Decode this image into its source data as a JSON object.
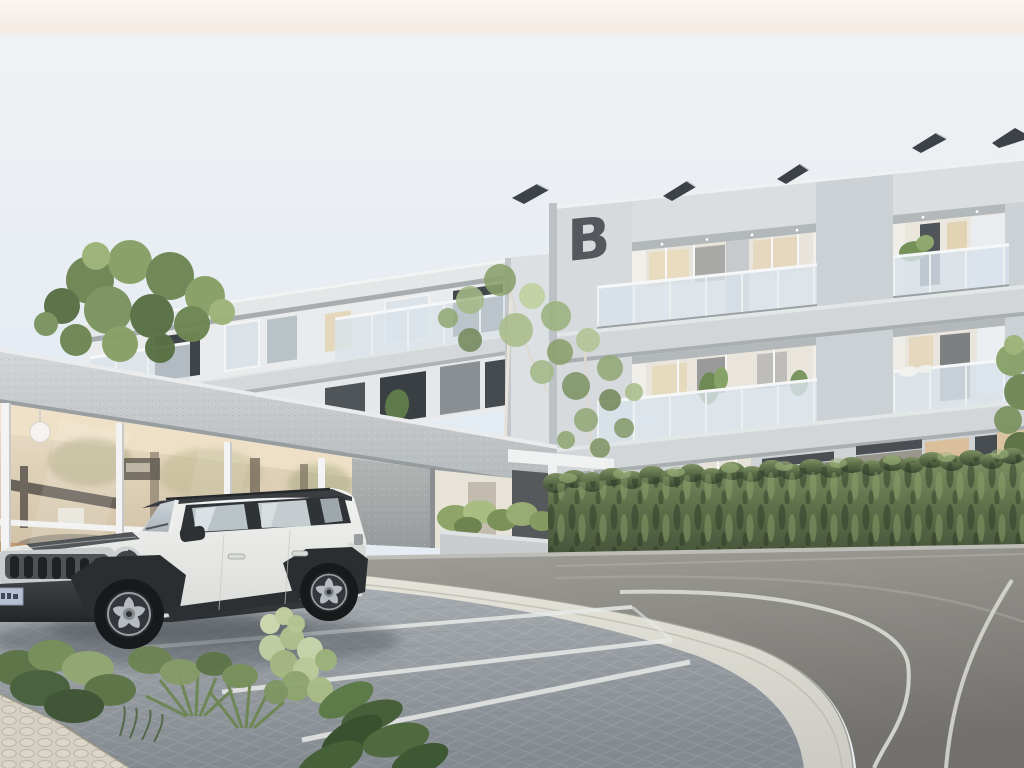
{
  "scene": {
    "kind": "3D architectural exterior rendering",
    "description": "Modern three-storey apartment complex with light concrete facade, recessed glass balconies, rooftop solar panels and a letter logo on the parapet; glazed amenity space under a concrete carport pergola; white compact SUV parked on a paver lot; tall green hedge along a curved asphalt road with white lane markings; landscaped shrubs and cobble walkway in the foreground",
    "time_of_day": "daylight"
  },
  "frame": {
    "width": 1024,
    "height": 768,
    "top_banner_color": "#f6ece5"
  },
  "sky": {
    "top": "#f1f2f3",
    "mid": "#e3ebf3",
    "bottom": "#e9eef2"
  },
  "building": {
    "logo_letter": "B",
    "logo_color": "#54585c",
    "facade_color": "#ccd1d5",
    "parapet_color": "#dadee0",
    "recess_color": "#f1efea",
    "balcony_glass_color": "#d8e2ea",
    "floors_visible": 3,
    "balcony_bays": 2,
    "solar_panels": 5,
    "solar_panel_color": "#3d4248"
  },
  "left_wing": {
    "facade_color": "#e9ebec",
    "roof_color": "#e4e7e8",
    "floors_visible": 2
  },
  "pergola": {
    "beam_color": "#d3d6d8",
    "column_color": "#f2f3f2"
  },
  "amenity": {
    "glass_top": "#ecdfc8",
    "glass_bottom": "#c8b89c",
    "lamp": "white globe pendant",
    "counter_color": "#b98a5c"
  },
  "entry": {
    "portal_color": "#f0f1f1",
    "gate_color": "#55595c",
    "stone_wall_color": "#aaadae",
    "planter_color": "#c9cdcf"
  },
  "vehicle": {
    "type": "compact SUV",
    "body_color": "#f2f3f1",
    "roof_color": "#3a3e41",
    "glass_color": "#b9c3c8",
    "grille_slots": 7,
    "plate_color": "#b7c0d2",
    "wheel_spoke_color": "#b6bbbf"
  },
  "landscape": {
    "hedge_top_color": "#7f9263",
    "hedge_mid_color": "#5a6b47",
    "hedge_bottom_color": "#3f4b35",
    "hedge_highlight": "#a3b77f",
    "birch_trunk_color": "#e6e2d8",
    "tree_foliage_colors": [
      "#a4b887",
      "#8aa06d",
      "#c0cf9f",
      "#75895c"
    ],
    "dark_tree_colors": [
      "#6e8653",
      "#87a066",
      "#597044"
    ],
    "pale_shrub_color": "#c2d0a3"
  },
  "ground": {
    "asphalt_light": "#a09e98",
    "asphalt_dark": "#73716d",
    "marking_bright": "#dcdcd6",
    "marking_faint": "#b2b0a9",
    "paver_light": "#a9aeb2",
    "paver_dark": "#848b90",
    "apron_color": "#e3e1d8",
    "parking_line_color": "#e8eae8",
    "parking_lines": 3,
    "cobble_color": "#d6d0c3",
    "sidewalk_color": "#bdbcb6"
  }
}
